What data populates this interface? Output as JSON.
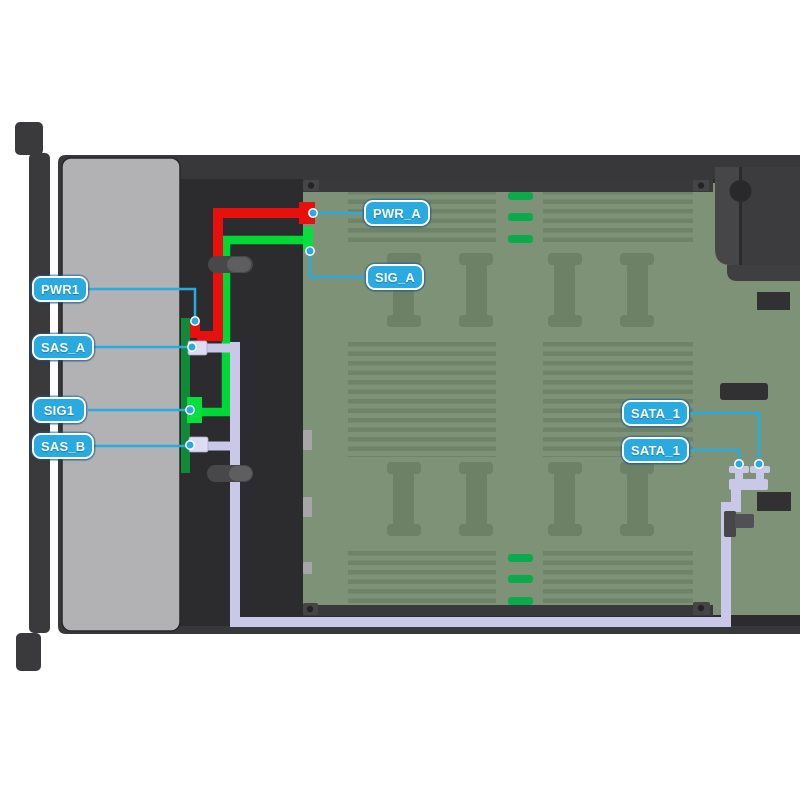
{
  "diagram": {
    "type": "server-cable-routing-top-view",
    "callouts": [
      {
        "id": "pwr_a",
        "label": "PWR_A"
      },
      {
        "id": "sig_a",
        "label": "SIG_A"
      },
      {
        "id": "pwr1",
        "label": "PWR1"
      },
      {
        "id": "sas_a",
        "label": "SAS_A"
      },
      {
        "id": "sig1",
        "label": "SIG1"
      },
      {
        "id": "sas_b",
        "label": "SAS_B"
      },
      {
        "id": "sata_1_upper",
        "label": "SATA_1"
      },
      {
        "id": "sata_1_lower",
        "label": "SATA_1"
      }
    ],
    "colors": {
      "callout_accent": "#29abe2",
      "power_cable": "#e8100c",
      "signal_cable": "#00d836",
      "sas_cable": "#c9c8e8",
      "backplane": "#0e8a38",
      "motherboard": "#7d9277",
      "chassis": "#38383a",
      "drive_bay": "#b2b2b5"
    }
  }
}
